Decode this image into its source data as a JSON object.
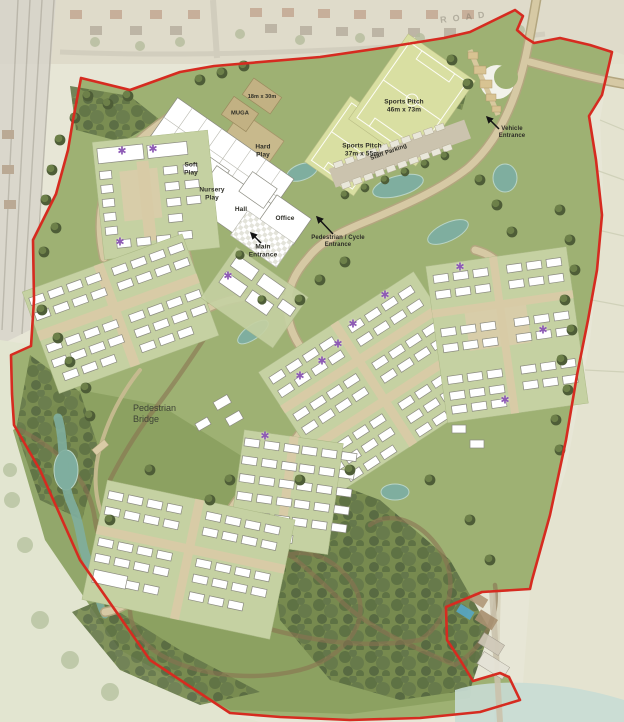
{
  "document": {
    "type": "Illustrative masterplan site plan"
  },
  "background": {
    "road_label": "ROAD"
  },
  "school_campus": {
    "muga_label": "MUGA",
    "muga_dims": "18m x 30m",
    "hard_play": "Hard Play",
    "soft_play": "Soft Play",
    "nursery_play": "Nursery Play",
    "hall": "Hall",
    "office": "Office",
    "main_entrance": "Main Entrance",
    "staff_parking": "Staff Parking",
    "pitch_small": {
      "name": "Sports Pitch",
      "dims": "37m x 55m"
    },
    "pitch_large": {
      "name": "Sports Pitch",
      "dims": "46m x 73m"
    }
  },
  "entrances": {
    "pedestrian_cycle": "Pedestrian / Cycle Entrance",
    "vehicle": "Vehicle Entrance"
  },
  "features": {
    "pedestrian_bridge": "Pedestrian Bridge"
  },
  "markers": {
    "affordable_star": {
      "glyph": "✱",
      "color": "#8e5bb5",
      "positions": [
        [
          122,
          152
        ],
        [
          153,
          150
        ],
        [
          120,
          243
        ],
        [
          228,
          277
        ],
        [
          385,
          296
        ],
        [
          353,
          325
        ],
        [
          338,
          345
        ],
        [
          322,
          362
        ],
        [
          300,
          377
        ],
        [
          265,
          437
        ],
        [
          460,
          268
        ],
        [
          543,
          331
        ],
        [
          505,
          401
        ]
      ]
    }
  },
  "palette": {
    "boundary_red": "#d62b20",
    "site_green": "#9eb173",
    "woodland_green": "#76894e",
    "road_tan": "#d6c9a4",
    "pond_teal": "#7fae9f",
    "pitch_green": "#d9dfa2",
    "building_white": "#ffffff"
  }
}
